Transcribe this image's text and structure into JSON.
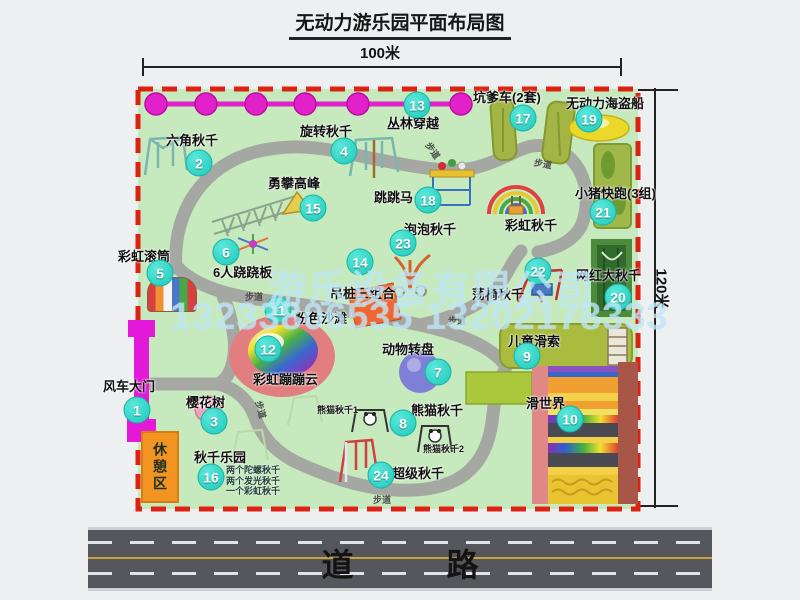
{
  "title": "无动力游乐园平面布局图",
  "dimensions": {
    "width_label": "100米",
    "height_label": "120米"
  },
  "road": {
    "label": "道  路"
  },
  "watermark": {
    "company": "游乐设备有限公司",
    "phone": "13233806535 13202178333"
  },
  "colors": {
    "map_green": "#c6e9bd",
    "border_red": "#dd2211",
    "path_gray": "#a5a7a3",
    "badge_cyan": "#1fc9bb",
    "chain_magenta": "#e020c8",
    "gate_magenta": "#e418d8",
    "rest_orange": "#f19422",
    "road_gray": "#56575d"
  },
  "map": {
    "rest_area_label": "休憩区",
    "rainbow_swing_label": "彩虹秋千",
    "panda_swing_1": "熊猫秋千1",
    "panda_swing_2": "熊猫秋千2",
    "swing_park_notes": [
      "两个陀螺秋千",
      "两个发光秋千",
      "一个彩虹秋千"
    ],
    "footpath_label": "步道",
    "footpaths": [
      {
        "x": 245,
        "y": 290,
        "r": 0
      },
      {
        "x": 448,
        "y": 314,
        "r": 0
      },
      {
        "x": 373,
        "y": 493,
        "r": 0
      },
      {
        "x": 424,
        "y": 144,
        "r": 55
      },
      {
        "x": 534,
        "y": 157,
        "r": 10
      },
      {
        "x": 252,
        "y": 403,
        "r": 75
      }
    ],
    "attractions": [
      {
        "num": "1",
        "name": "风车大门",
        "badge": [
          137,
          410
        ],
        "label": [
          103,
          376
        ]
      },
      {
        "num": "2",
        "name": "六角秋千",
        "badge": [
          199,
          163
        ],
        "label": [
          166,
          130
        ]
      },
      {
        "num": "3",
        "name": "樱花树",
        "badge": [
          214,
          421
        ],
        "label": [
          186,
          392
        ]
      },
      {
        "num": "4",
        "name": "旋转秋千",
        "badge": [
          344,
          151
        ],
        "label": [
          300,
          121
        ]
      },
      {
        "num": "5",
        "name": "彩虹滚筒",
        "badge": [
          160,
          273
        ],
        "label": [
          118,
          246
        ]
      },
      {
        "num": "6",
        "name": "6人跷跷板",
        "badge": [
          226,
          252
        ],
        "label": [
          213,
          262
        ]
      },
      {
        "num": "7",
        "name": "动物转盘",
        "badge": [
          438,
          372
        ],
        "label": [
          382,
          339
        ]
      },
      {
        "num": "8",
        "name": "熊猫秋千",
        "badge": [
          403,
          423
        ],
        "label": [
          411,
          400
        ]
      },
      {
        "num": "9",
        "name": "儿童滑索",
        "badge": [
          527,
          356
        ],
        "label": [
          508,
          331
        ]
      },
      {
        "num": "10",
        "name": "滑世界",
        "badge": [
          570,
          419
        ],
        "label": [
          526,
          393
        ]
      },
      {
        "num": "11",
        "name": "粉色沙滩",
        "badge": [
          278,
          310
        ],
        "label": [
          295,
          308
        ]
      },
      {
        "num": "12",
        "name": "彩虹蹦蹦云",
        "badge": [
          268,
          349
        ],
        "label": [
          253,
          369
        ]
      },
      {
        "num": "13",
        "name": "丛林穿越",
        "badge": [
          417,
          105
        ],
        "label": [
          387,
          113
        ]
      },
      {
        "num": "14",
        "name": "吊桩三组合",
        "badge": [
          360,
          262
        ],
        "label": [
          330,
          283
        ]
      },
      {
        "num": "15",
        "name": "勇攀高峰",
        "badge": [
          313,
          208
        ],
        "label": [
          268,
          173
        ]
      },
      {
        "num": "16",
        "name": "秋千乐园",
        "badge": [
          211,
          477
        ],
        "label": [
          194,
          447
        ]
      },
      {
        "num": "17",
        "name": "坑爹车(2套)",
        "badge": [
          523,
          118
        ],
        "label": [
          473,
          87
        ]
      },
      {
        "num": "18",
        "name": "跳跳马",
        "badge": [
          428,
          200
        ],
        "label": [
          374,
          187
        ]
      },
      {
        "num": "19",
        "name": "无动力海盗船",
        "badge": [
          589,
          119
        ],
        "label": [
          566,
          93
        ]
      },
      {
        "num": "20",
        "name": "网红大秋千",
        "badge": [
          618,
          297
        ],
        "label": [
          576,
          265
        ]
      },
      {
        "num": "21",
        "name": "小猪快跑(3组)",
        "badge": [
          603,
          212
        ],
        "label": [
          575,
          183
        ]
      },
      {
        "num": "22",
        "name": "荡椅秋千",
        "badge": [
          538,
          271
        ],
        "label": [
          472,
          284
        ]
      },
      {
        "num": "23",
        "name": "泡泡秋千",
        "badge": [
          403,
          243
        ],
        "label": [
          404,
          219
        ]
      },
      {
        "num": "24",
        "name": "超级秋千",
        "badge": [
          381,
          475
        ],
        "label": [
          392,
          463
        ]
      }
    ]
  }
}
